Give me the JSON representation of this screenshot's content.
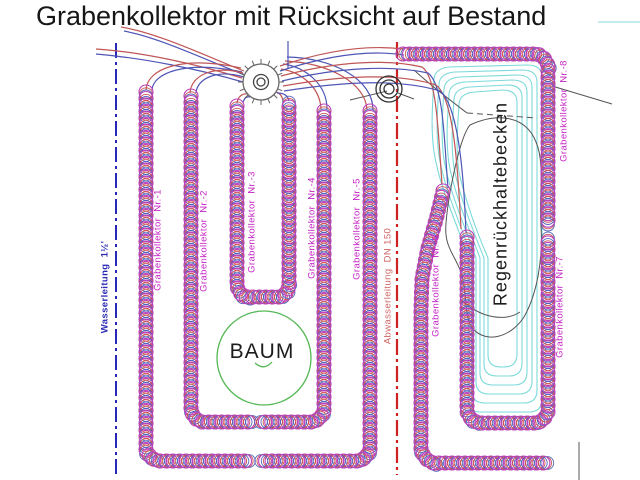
{
  "title": "Grabenkollektor mit Rücksicht auf Bestand",
  "colors": {
    "coil_magenta": "#bb44bb",
    "coil_red": "#cc5555",
    "coil_blue": "#5566bb",
    "pipe_red": "#c05555",
    "pipe_blue": "#4f55b5",
    "water_line": "#2828b8",
    "sewer_line": "#cc2222",
    "contour_cyan": "#7cd9d9",
    "tree_green": "#55b855",
    "annotation_black": "#555555",
    "label_magenta": "#c41fc4"
  },
  "collectors": [
    {
      "label": "Grabenkollektor  Nr.-1",
      "x": 158,
      "y": 240
    },
    {
      "label": "Grabenkollektor  Nr.-2",
      "x": 204,
      "y": 241
    },
    {
      "label": "Grabenkollektor  Nr.-3",
      "x": 252,
      "y": 222
    },
    {
      "label": "Grabenkollektor  Nr.-4",
      "x": 312,
      "y": 228
    },
    {
      "label": "Grabenkollektor  Nr.-5",
      "x": 357,
      "y": 229
    },
    {
      "label": "Grabenkollektor  Nr.-6",
      "x": 436,
      "y": 286
    },
    {
      "label": "Grabenkollektor  Nr.-7",
      "x": 560,
      "y": 307
    },
    {
      "label": "Grabenkollektor  Nr.-8",
      "x": 564,
      "y": 111
    }
  ],
  "utilities": {
    "water": {
      "label": "Wasserleitung  1½'",
      "x": 105,
      "y": 287,
      "line_x": 116,
      "y1": 43,
      "y2": 476
    },
    "sewer": {
      "label": "Abwasserleitung  DN 150",
      "x": 388,
      "y": 286,
      "line_x": 397,
      "y1": 42,
      "y2": 475
    }
  },
  "basin": {
    "label": "Regenrückhaltebecken",
    "label_x": 501,
    "label_y": 204,
    "contour_count": 6,
    "outer": {
      "top": 65,
      "right": 542,
      "bottom": 412,
      "left_upper": 434,
      "left_lower": 468
    },
    "insets": {
      "top": 5,
      "right": 5,
      "bottom": 9,
      "left_upper": 5,
      "left_lower": 4
    }
  },
  "tree": {
    "label": "BAUM",
    "label_x": 262,
    "label_y": 352,
    "cx": 264,
    "cy": 358,
    "r": 47
  },
  "manholes": [
    {
      "name": "distributor-shaft",
      "cx": 261,
      "cy": 82,
      "r_outer": 18,
      "r_mid": 7.5,
      "r_inner": 4,
      "ticks": 16
    },
    {
      "name": "sewer-manhole",
      "cx": 389,
      "cy": 89,
      "rings": [
        13,
        9,
        5
      ]
    }
  ],
  "coil_runs": [
    {
      "name": "grabenkollektor-1",
      "points": [
        [
          146,
          92
        ],
        [
          146,
          450
        ],
        [
          151,
          458
        ],
        [
          158,
          461
        ],
        [
          248,
          461
        ]
      ]
    },
    {
      "name": "grabenkollektor-2",
      "points": [
        [
          191,
          96
        ],
        [
          191,
          412
        ],
        [
          196,
          419
        ],
        [
          202,
          422
        ],
        [
          252,
          422
        ]
      ]
    },
    {
      "name": "grabenkollektor-3",
      "points": [
        [
          237,
          106
        ],
        [
          237,
          287
        ],
        [
          241,
          294
        ],
        [
          247,
          297
        ],
        [
          279,
          297
        ],
        [
          285,
          294
        ],
        [
          289,
          287
        ],
        [
          289,
          105
        ]
      ]
    },
    {
      "name": "grabenkollektor-4",
      "points": [
        [
          324,
          111
        ],
        [
          324,
          412
        ],
        [
          319,
          419
        ],
        [
          313,
          422
        ],
        [
          263,
          422
        ]
      ]
    },
    {
      "name": "grabenkollektor-5",
      "points": [
        [
          370,
          111
        ],
        [
          370,
          450
        ],
        [
          365,
          458
        ],
        [
          359,
          461
        ],
        [
          265,
          461
        ]
      ]
    },
    {
      "name": "grabenkollektor-6",
      "points": [
        [
          443,
          191
        ],
        [
          437,
          216
        ],
        [
          428,
          248
        ],
        [
          422,
          278
        ],
        [
          421,
          310
        ],
        [
          421,
          451
        ],
        [
          426,
          459
        ],
        [
          433,
          463
        ],
        [
          546,
          463
        ]
      ]
    },
    {
      "name": "grabenkollektor-7",
      "points": [
        [
          467,
          237
        ],
        [
          467,
          412
        ],
        [
          471,
          419
        ],
        [
          478,
          423
        ],
        [
          538,
          423
        ],
        [
          544,
          419
        ],
        [
          548,
          412
        ],
        [
          548,
          239
        ]
      ]
    },
    {
      "name": "grabenkollektor-8",
      "points": [
        [
          403,
          54
        ],
        [
          538,
          54
        ],
        [
          544,
          58
        ],
        [
          548,
          65
        ],
        [
          548,
          222
        ]
      ]
    }
  ],
  "pipes": [
    {
      "color": "red",
      "d": "M121,27 C158,33 206,56 244,71"
    },
    {
      "color": "blue",
      "d": "M124,31 C161,38 208,61 245,75"
    },
    {
      "color": "red",
      "d": "M96,49 C142,52 196,64 242,78"
    },
    {
      "color": "blue",
      "d": "M96,54 C143,58 198,69 243,82"
    },
    {
      "color": "red",
      "d": "M146,90 C147,69 181,55 241,68"
    },
    {
      "color": "blue",
      "d": "M152,90 C153,73 185,60 242,72"
    },
    {
      "color": "red",
      "d": "M190,93 C191,75 214,65 243,73"
    },
    {
      "color": "blue",
      "d": "M196,93 C197,78 218,69 244,77"
    },
    {
      "color": "red",
      "d": "M237,103 C238,96 243,93 248,94"
    },
    {
      "color": "blue",
      "d": "M243,103 C244,98 247,96 250,97"
    },
    {
      "color": "red",
      "d": "M283,101 C282,94 277,91 271,91"
    },
    {
      "color": "blue",
      "d": "M289,101 C288,95 283,93 277,93"
    },
    {
      "color": "red",
      "d": "M321,109 C320,87 301,72 281,69"
    },
    {
      "color": "blue",
      "d": "M327,109 C327,84 305,67 283,64"
    },
    {
      "color": "red",
      "d": "M367,110 C366,83 329,63 285,61"
    },
    {
      "color": "blue",
      "d": "M373,110 C373,79 333,58 287,57"
    },
    {
      "color": "red",
      "d": "M280,66 C330,49 370,45 403,49"
    },
    {
      "color": "blue",
      "d": "M280,71 C332,54 372,50 404,55"
    },
    {
      "color": "red",
      "d": "M281,76 C338,61 388,59 422,67 C437,77 438,130 442,184"
    },
    {
      "color": "blue",
      "d": "M282,81 C340,67 392,65 428,73 C444,85 444,140 448,188"
    },
    {
      "color": "red",
      "d": "M283,86 C345,75 398,73 436,85 C454,98 458,170 461,229"
    },
    {
      "color": "blue",
      "d": "M284,91 C348,81 401,79 440,91 C459,106 464,180 466,233"
    },
    {
      "color": "blue",
      "d": "M288,41 L288,69"
    }
  ],
  "annotations": [
    {
      "name": "leader-line-a",
      "d": "M350,100 L387,91",
      "dash": ""
    },
    {
      "name": "leader-line-b",
      "d": "M398,93 L414,99",
      "dash": ""
    },
    {
      "name": "existing-line-diagonal",
      "d": "M414,70 C430,85 450,100 467,113",
      "dash": ""
    },
    {
      "name": "existing-line-dashed",
      "d": "M467,113 L537,118",
      "dash": "6 4"
    },
    {
      "name": "existing-line-topright",
      "d": "M552,86 L612,104",
      "dash": ""
    },
    {
      "name": "boundary-line-bottomright",
      "d": "M579,442 L579,480",
      "dash": ""
    },
    {
      "name": "existing-pond-outline",
      "d": "M470,125 C498,112 526,116 536,142 C545,163 539,192 541,226 C543,260 537,294 524,317 C511,337 487,344 473,329 C463,316 468,294 461,272 C453,252 444,246 446,223 C448,198 459,138 470,125 Z",
      "dash": ""
    },
    {
      "name": "existing-pond-arc",
      "d": "M462,300 C480,318 505,322 520,312",
      "dash": ""
    },
    {
      "name": "survey-tick-cyan",
      "d": "M598,22 L640,22",
      "dash": "",
      "color": "#8adada"
    }
  ],
  "tree_trunk_arc": "M255,363 Q264,371 272,362",
  "coil_style": {
    "step": 6.5,
    "radius": 7,
    "accent_radius": 6.4
  }
}
